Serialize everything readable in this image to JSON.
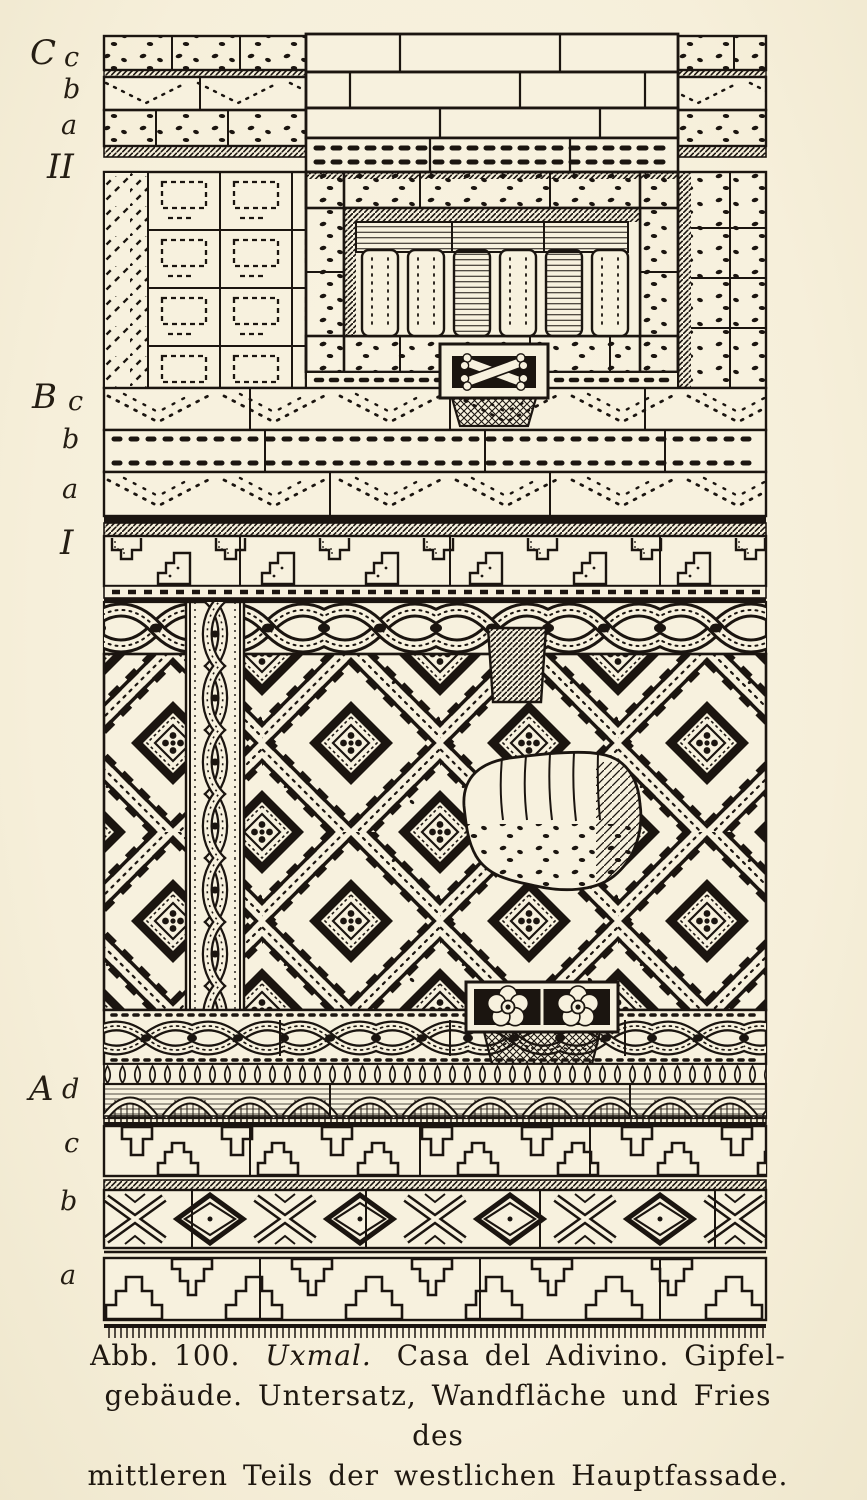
{
  "palette": {
    "paper": "#f7f1de",
    "ink": "#1b1510"
  },
  "labels": [
    {
      "id": "C",
      "text": "C"
    },
    {
      "id": "C-c",
      "text": "c"
    },
    {
      "id": "C-b",
      "text": "b"
    },
    {
      "id": "C-a",
      "text": "a"
    },
    {
      "id": "II",
      "text": "II"
    },
    {
      "id": "B",
      "text": "B"
    },
    {
      "id": "B-c",
      "text": "c"
    },
    {
      "id": "B-b",
      "text": "b"
    },
    {
      "id": "B-a",
      "text": "a"
    },
    {
      "id": "I",
      "text": "I"
    },
    {
      "id": "A",
      "text": "A"
    },
    {
      "id": "A-d",
      "text": "d"
    },
    {
      "id": "A-c",
      "text": "c"
    },
    {
      "id": "A-b",
      "text": "b"
    },
    {
      "id": "A-a",
      "text": "a"
    }
  ],
  "caption": {
    "line1_prefix": "Abb. 100.",
    "line1_italic": "Uxmal.",
    "line1_rest": "Casa del Adivino. Gipfel-",
    "line2": "gebäude. Untersatz, Wandfläche und Fries des",
    "line3": "mittleren Teils der westlichen Hauptfassade."
  }
}
